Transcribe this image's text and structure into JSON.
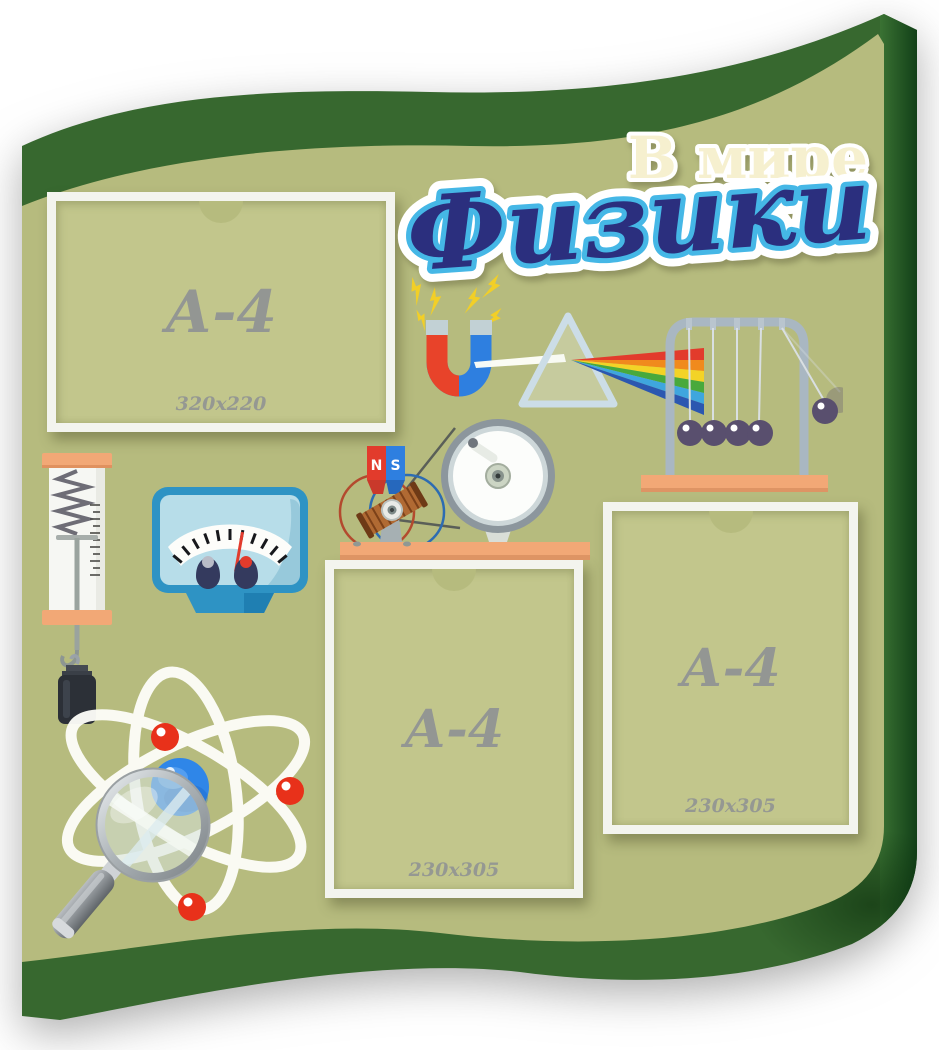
{
  "title": {
    "line1": "В мире",
    "line2": "Физики"
  },
  "pockets": [
    {
      "label": "А-4",
      "size": "320x220"
    },
    {
      "label": "А-4",
      "size": "230x305"
    },
    {
      "label": "А-4",
      "size": "230x305"
    }
  ],
  "generator_magnet": {
    "north": "N",
    "south": "S"
  },
  "icons": [
    "lightning-bolts",
    "horseshoe-magnet",
    "prism-spectrum",
    "newtons-cradle",
    "spring-dynamometer",
    "hanging-weight",
    "voltmeter",
    "hand-generator",
    "atom-orbits",
    "magnifying-glass"
  ],
  "colors": {
    "panel_khaki": "#b6bb7e",
    "frame_green": "#37682f",
    "frame_green_dark": "#124018",
    "pocket_fill": "#c2c68c",
    "pocket_border": "#f3f4ee",
    "base_orange": "#f2a876",
    "title_cream": "#f6f0cf",
    "title_navy": "#2b2f7e",
    "title_cyan": "#45b7e6",
    "label_gray": "#8e9194",
    "magnet_red": "#e8432a",
    "magnet_blue": "#2e7fe0",
    "bolt_yellow": "#f2cf27"
  }
}
